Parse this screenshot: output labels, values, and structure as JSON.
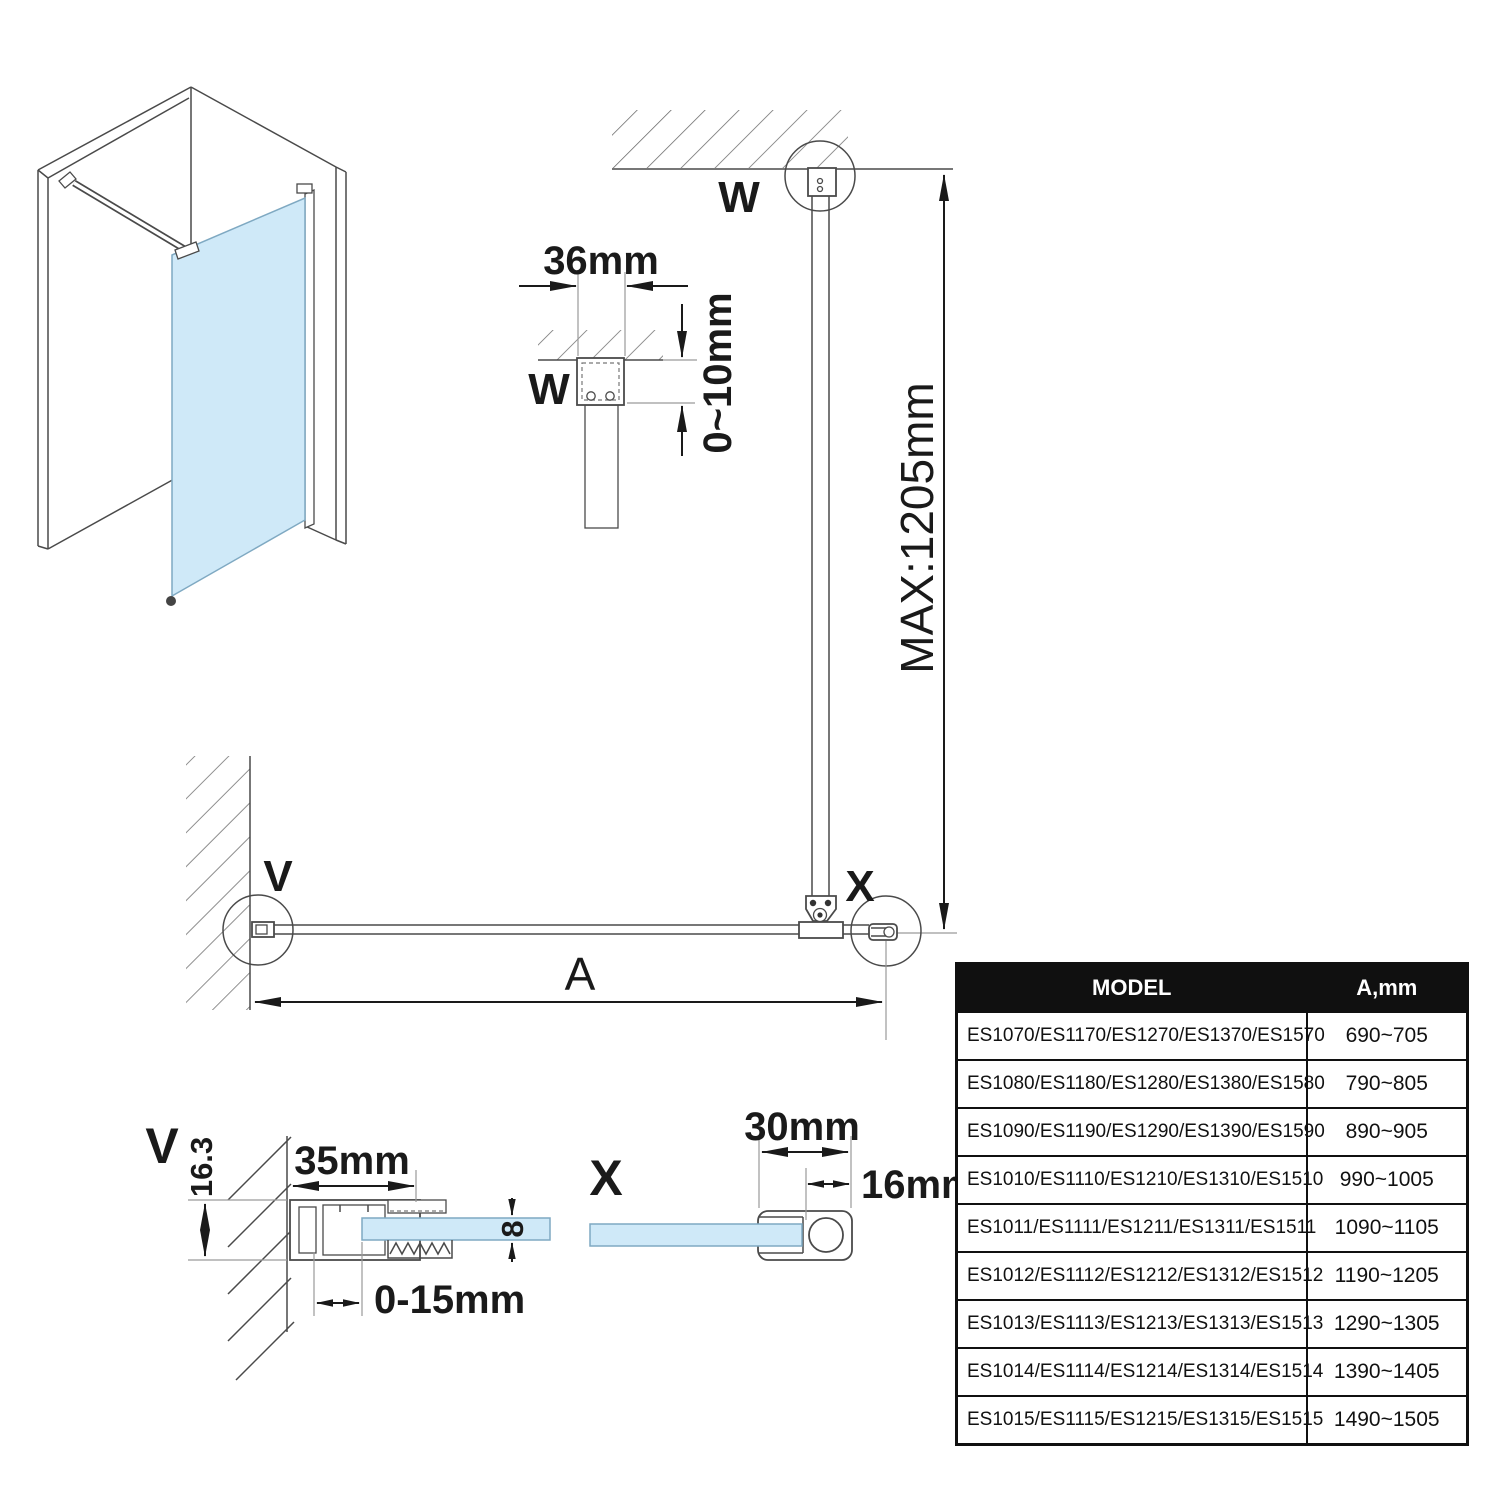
{
  "labels": {
    "elev_w": "W",
    "detail_w": "W",
    "plan_v": "V",
    "plan_x": "X",
    "detail_v": "V",
    "detail_x": "X"
  },
  "dims": {
    "bracket_width": "36mm",
    "ceiling_gap": "0~10mm",
    "max_length": "MAX:1205mm",
    "width_a": "A",
    "profile_depth": "16.3",
    "profile_width": "35mm",
    "adjust": "0-15mm",
    "glass_thickness": "8",
    "end_width": "30mm",
    "end_inset": "16mm"
  },
  "colors": {
    "glass": "#cfe9f8",
    "glass_border": "#7fa9c2",
    "line": "#4a4a4a",
    "dimension": "#1a1a1a",
    "table_header_bg": "#101010",
    "table_header_text": "#ffffff"
  },
  "table": {
    "headers": {
      "model": "MODEL",
      "a": "A,mm"
    },
    "rows": [
      {
        "model": "ES1070/ES1170/ES1270/ES1370/ES1570",
        "a": "690~705"
      },
      {
        "model": "ES1080/ES1180/ES1280/ES1380/ES1580",
        "a": "790~805"
      },
      {
        "model": "ES1090/ES1190/ES1290/ES1390/ES1590",
        "a": "890~905"
      },
      {
        "model": "ES1010/ES1110/ES1210/ES1310/ES1510",
        "a": "990~1005"
      },
      {
        "model": "ES1011/ES1111/ES1211/ES1311/ES1511",
        "a": "1090~1105"
      },
      {
        "model": "ES1012/ES1112/ES1212/ES1312/ES1512",
        "a": "1190~1205"
      },
      {
        "model": "ES1013/ES1113/ES1213/ES1313/ES1513",
        "a": "1290~1305"
      },
      {
        "model": "ES1014/ES1114/ES1214/ES1314/ES1514",
        "a": "1390~1405"
      },
      {
        "model": "ES1015/ES1115/ES1215/ES1315/ES1515",
        "a": "1490~1505"
      }
    ]
  }
}
